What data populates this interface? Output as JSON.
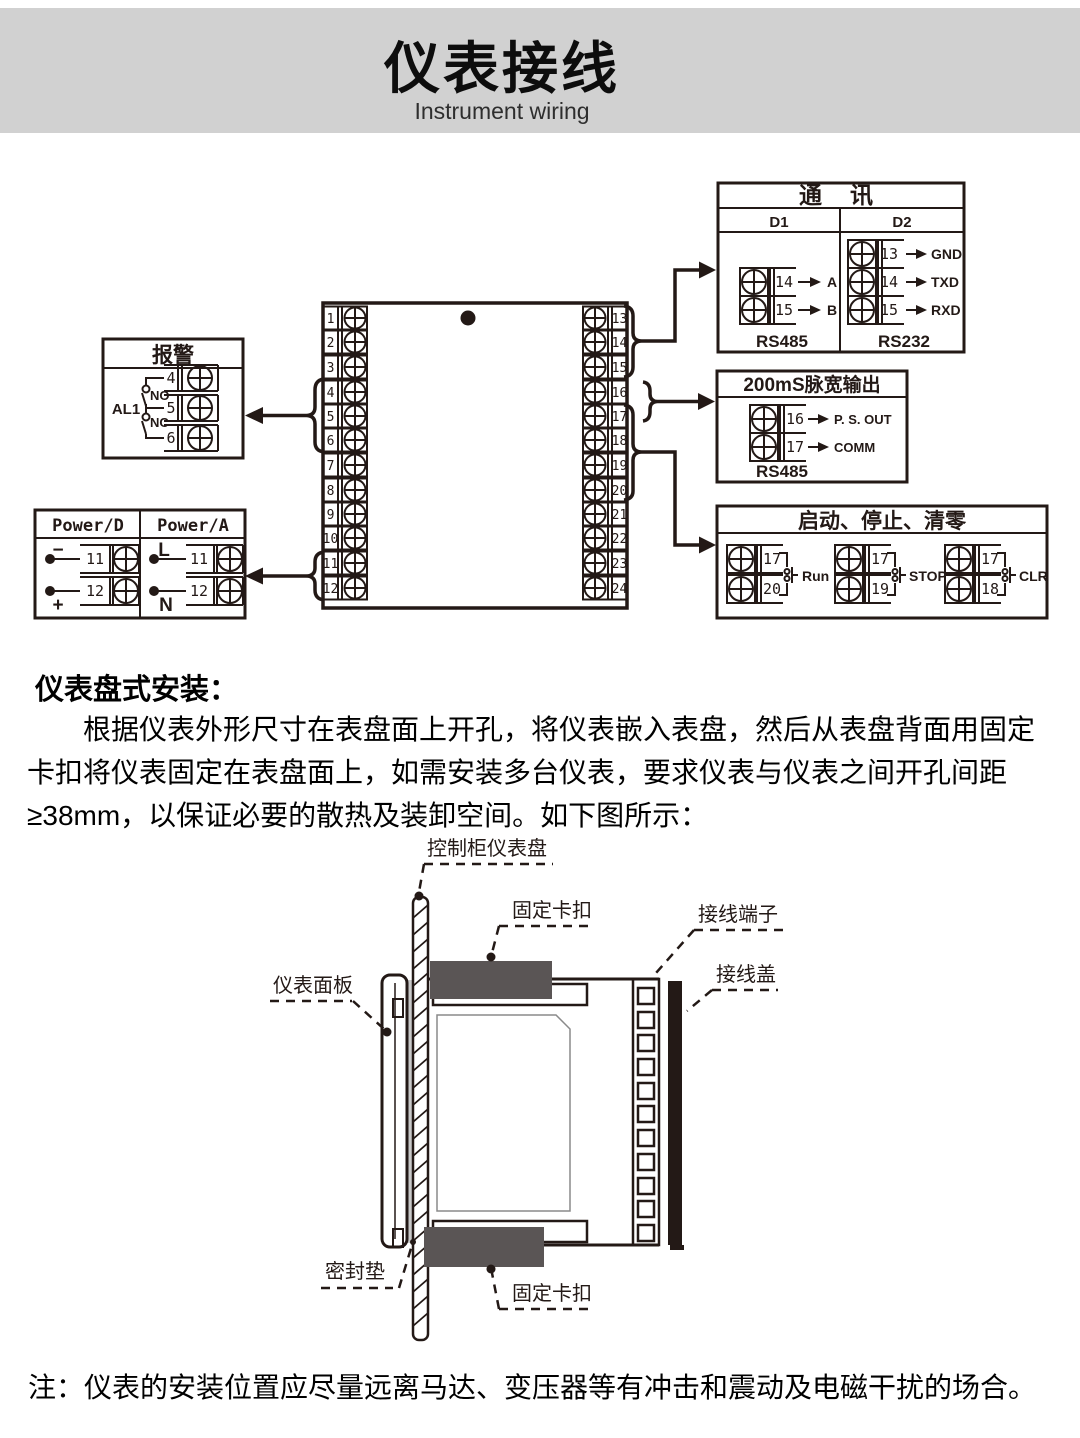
{
  "header": {
    "title": "仪表接线",
    "subtitle": "Instrument wiring"
  },
  "wiring": {
    "block": {
      "left": [
        "1",
        "2",
        "3",
        "4",
        "5",
        "6",
        "7",
        "8",
        "9",
        "10",
        "11",
        "12"
      ],
      "right": [
        "13",
        "14",
        "15",
        "16",
        "17",
        "18",
        "19",
        "20",
        "21",
        "22",
        "23",
        "24"
      ]
    },
    "alarm": {
      "title": "报警",
      "group": "AL1",
      "no": "NO",
      "nc": "NC",
      "t1": "4",
      "t2": "5",
      "t3": "6"
    },
    "power": {
      "d_title": "Power/D",
      "a_title": "Power/A",
      "d_rows": [
        {
          "sign": "−",
          "num": "11"
        },
        {
          "sign": "+",
          "num": "12"
        }
      ],
      "a_rows": [
        {
          "sign": "L",
          "num": "11"
        },
        {
          "sign": "N",
          "num": "12"
        }
      ]
    },
    "comm": {
      "title": "通讯",
      "d1": "D1",
      "d2": "D2",
      "d1_rows": [
        {
          "num": "14",
          "sig": "A"
        },
        {
          "num": "15",
          "sig": "B"
        }
      ],
      "d2_rows": [
        {
          "num": "13",
          "sig": "GND"
        },
        {
          "num": "14",
          "sig": "TXD"
        },
        {
          "num": "15",
          "sig": "RXD"
        }
      ],
      "d1_bus": "RS485",
      "d2_bus": "RS232"
    },
    "pulse": {
      "title": "200mS脉宽输出",
      "rows": [
        {
          "num": "16",
          "sig": "P. S. OUT"
        },
        {
          "num": "17",
          "sig": "COMM"
        }
      ],
      "bus": "RS485"
    },
    "control": {
      "title": "启动、停止、清零",
      "groups": [
        {
          "top": "17",
          "bottom": "20",
          "label": "Run"
        },
        {
          "top": "17",
          "bottom": "19",
          "label": "STOP"
        },
        {
          "top": "17",
          "bottom": "18",
          "label": "CLR"
        }
      ]
    }
  },
  "install": {
    "heading": "仪表盘式安装：",
    "paragraph": "根据仪表外形尺寸在表盘面上开孔，将仪表嵌入表盘，然后从表盘背面用固定卡扣将仪表固定在表盘面上，如需安装多台仪表，要求仪表与仪表之间开孔间距≥38mm，以保证必要的散热及装卸空间。如下图所示："
  },
  "mounting": {
    "panel_label": "控制柜仪表盘",
    "clip_top_label": "固定卡扣",
    "terminal_label": "接线端子",
    "cover_label": "接线盖",
    "faceplate_label": "仪表面板",
    "gasket_label": "密封垫",
    "clip_bottom_label": "固定卡扣"
  },
  "note": "注：仪表的安装位置应尽量远离马达、变压器等有冲击和震动及电磁干扰的场合。",
  "colors": {
    "ink": "#231916",
    "band": "#d1d1d1",
    "clip_gray": "#5a5555",
    "gasket_gray": "#c9c9c9"
  }
}
